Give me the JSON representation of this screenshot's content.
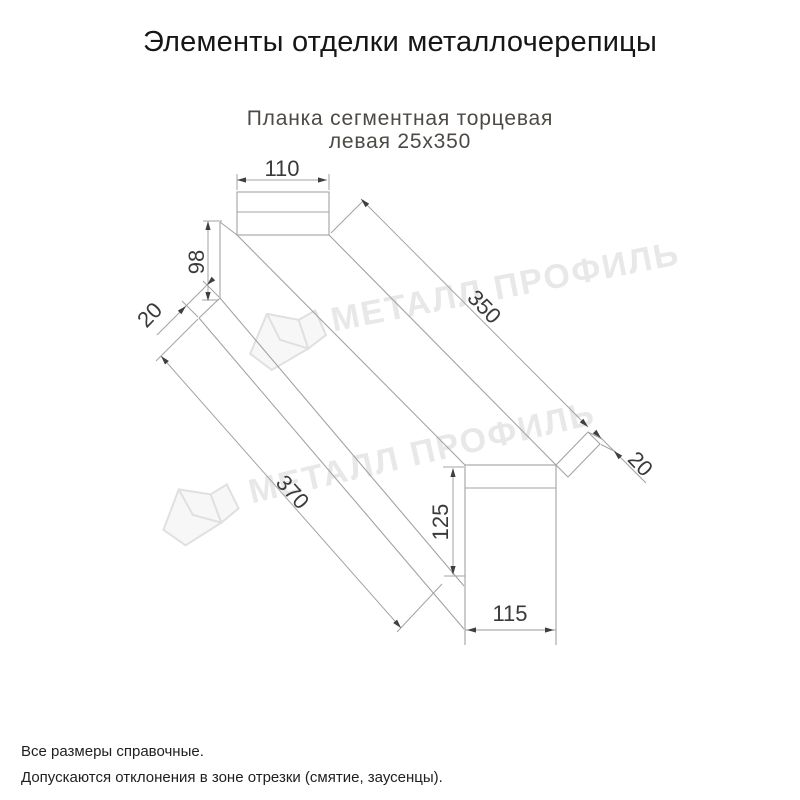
{
  "page": {
    "title": "Элементы отделки металлочерепицы"
  },
  "drawing": {
    "caption_line1": "Планка сегментная торцевая",
    "caption_line2": "левая 25х350",
    "dimensions": {
      "top_flange_width": "110",
      "side_height": "98",
      "near_hem": "20",
      "top_length": "350",
      "bottom_length": "370",
      "end_cap_height": "125",
      "end_cap_width": "115",
      "far_hem": "20"
    },
    "watermark_text": "МЕТАЛЛ ПРОФИЛЬ",
    "colors": {
      "line": "#a3a3a3",
      "dim_text": "#3a3a3a",
      "watermark": "#e8e8e8"
    }
  },
  "footer": {
    "line1": "Все размеры справочные.",
    "line2": "Допускаются отклонения в зоне отрезки (смятие, заусенцы)."
  }
}
